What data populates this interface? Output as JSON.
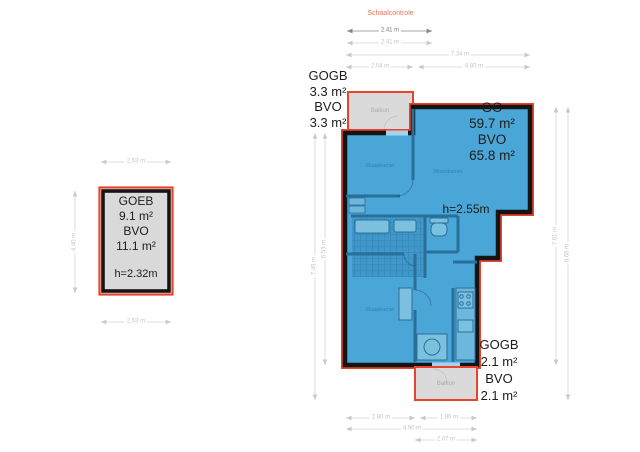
{
  "colors": {
    "accent_red": "#e8432c",
    "plan_fill": "#4aa6d6",
    "wall_black": "#141414",
    "wall_interior": "#2a6f9a",
    "balcony_fill": "#dadada",
    "dim_light": "#c9c9c9",
    "dim_dark": "#8a8a8a",
    "scale_title": "#e8735c"
  },
  "scale_check": {
    "title": "Schaalcontrole",
    "primary": "2.41 m",
    "secondary": "2.41 m"
  },
  "goeb": {
    "name": "GOEB",
    "go_area": "9.1 m²",
    "bvo_label": "BVO",
    "bvo_area": "11.1 m²",
    "height": "h=2.32m",
    "dim_top": "2.53 m",
    "dim_bottom": "2.53 m",
    "dim_left": "4.40 m"
  },
  "main": {
    "go_label": "GO",
    "go_area": "59.7 m²",
    "bvo_label": "BVO",
    "bvo_area": "65.8 m²",
    "height": "h=2.55m",
    "balcony_top": {
      "name": "Balkon",
      "gogb": "GOGB",
      "gogb_area": "3.3 m²",
      "bvo": "BVO",
      "bvo_area": "3.3 m²"
    },
    "balcony_bottom": {
      "name": "Balkon",
      "gogb": "GOGB",
      "gogb_area": "2.1 m²",
      "bvo": "BVO",
      "bvo_area": "2.1 m²"
    },
    "rooms": {
      "bedroom_top": "Slaapkamer",
      "bedroom_bottom": "Slaapkamer",
      "living": "Woonkamer"
    }
  },
  "dims": {
    "top_total": "7.34 m",
    "top_left": "2.54 m",
    "top_right": "4.80 m",
    "bottom_left": "2.80 m",
    "bottom_right": "1.86 m",
    "bottom_total": "4.90 m",
    "bottom_balcony": "2.07 m",
    "right_inner": "7.61 m",
    "right_outer": "8.68 m",
    "left_inner": "6.53 m",
    "left_outer": "7.45 m"
  }
}
